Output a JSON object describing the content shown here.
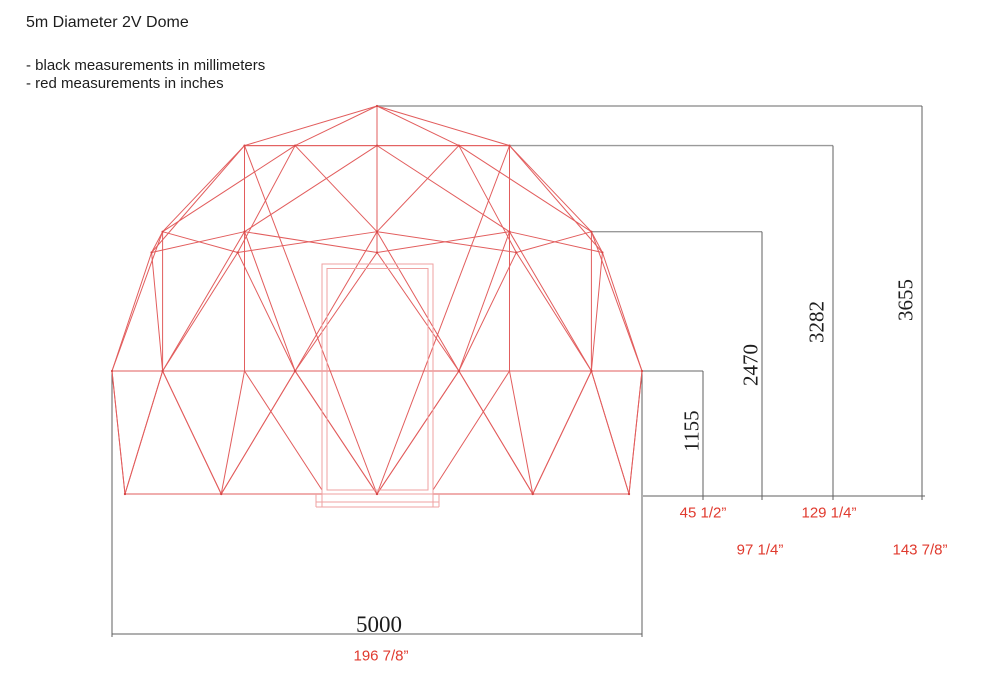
{
  "title": "5m Diameter 2V Dome",
  "legend": {
    "black_note": "- black measurements in millimeters",
    "red_note": "- red measurements in inches"
  },
  "colors": {
    "frame_red": "#e25d5d",
    "door_red": "#efa2a2",
    "hub_red": "#d64545",
    "mm_text": "#1d1d1d",
    "inch_text": "#e03a2e",
    "dim_line": "#5f5f5f",
    "ext_line": "#9a9a9a"
  },
  "dimensions": {
    "base_width": {
      "mm": "5000",
      "inches": "196 7/8”"
    },
    "riser_height": {
      "mm": "1155",
      "inches": "45 1/2”"
    },
    "belt_height": {
      "mm": "2470",
      "inches": "97 1/4”"
    },
    "ring_height": {
      "mm": "3282",
      "inches": "129 1/4”"
    },
    "total_height": {
      "mm": "3655",
      "inches": "143 7/8”"
    }
  }
}
